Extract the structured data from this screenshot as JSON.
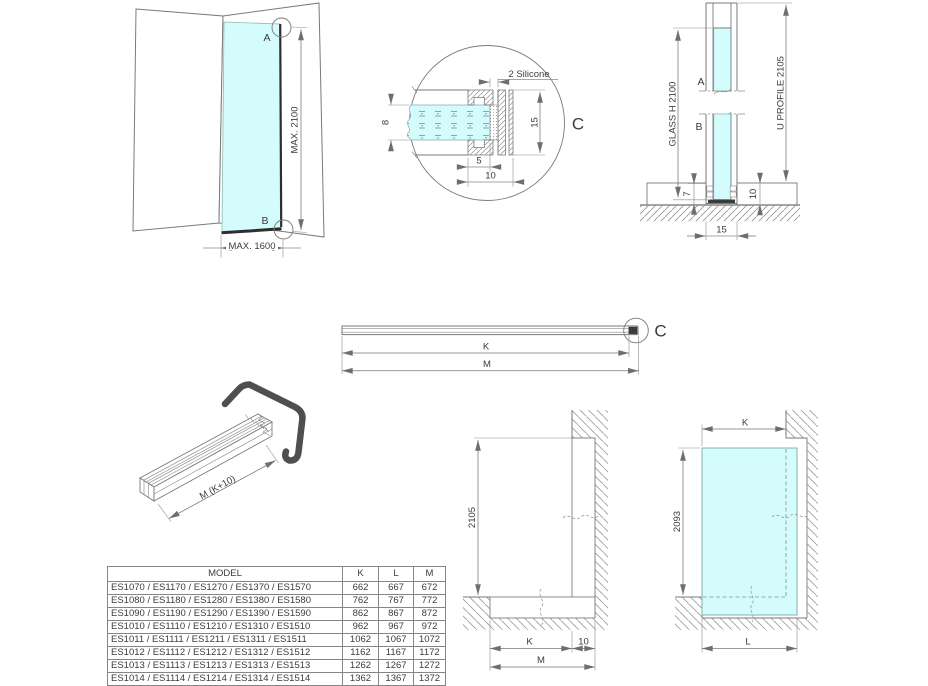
{
  "colors": {
    "glass": "#d4fcfc",
    "dark": "#3c3c3c",
    "bracket": "#4f4f4f"
  },
  "installation_view": {
    "point_a": "A",
    "point_b": "B",
    "max_height": "MAX. 2100",
    "max_width": "MAX. 1600"
  },
  "detail_c": {
    "callout": "C",
    "silicone_label": "2 Silicone",
    "glass_thickness": "8",
    "inner_depth": "5",
    "outer_width": "10",
    "height": "15"
  },
  "section_view": {
    "point_a": "A",
    "point_b": "B",
    "glass_height_label": "GLASS H 2100",
    "u_profile_label": "U PROFILE 2105",
    "dim_glass_offset": "7",
    "dim_floor_depth": "10",
    "dim_profile_width": "15"
  },
  "profile_bar": {
    "dim_k": "K",
    "dim_m": "M",
    "callout": "C"
  },
  "profile_3d": {
    "length_label": "M (K+10)"
  },
  "elevation_view": {
    "dim_height": "2105",
    "dim_k": "K",
    "dim_wall_depth": "10",
    "dim_m": "M"
  },
  "glass_elevation": {
    "dim_k": "K",
    "dim_height": "2093",
    "dim_l": "L"
  },
  "size_table": {
    "headers": {
      "model": "MODEL",
      "k": "K",
      "l": "L",
      "m": "M"
    },
    "rows": [
      {
        "model": "ES1070 / ES1170 / ES1270 / ES1370 / ES1570",
        "k": "662",
        "l": "667",
        "m": "672"
      },
      {
        "model": "ES1080 / ES1180 / ES1280 / ES1380 / ES1580",
        "k": "762",
        "l": "767",
        "m": "772"
      },
      {
        "model": "ES1090 / ES1190 / ES1290 / ES1390 / ES1590",
        "k": "862",
        "l": "867",
        "m": "872"
      },
      {
        "model": "ES1010 / ES1110 / ES1210 / ES1310 / ES1510",
        "k": "962",
        "l": "967",
        "m": "972"
      },
      {
        "model": "ES1011 / ES1111 / ES1211 / ES1311 / ES1511",
        "k": "1062",
        "l": "1067",
        "m": "1072"
      },
      {
        "model": "ES1012 / ES1112 / ES1212 / ES1312 / ES1512",
        "k": "1162",
        "l": "1167",
        "m": "1172"
      },
      {
        "model": "ES1013 / ES1113 / ES1213 / ES1313 / ES1513",
        "k": "1262",
        "l": "1267",
        "m": "1272"
      },
      {
        "model": "ES1014 / ES1114 / ES1214 / ES1314 / ES1514",
        "k": "1362",
        "l": "1367",
        "m": "1372"
      }
    ]
  }
}
